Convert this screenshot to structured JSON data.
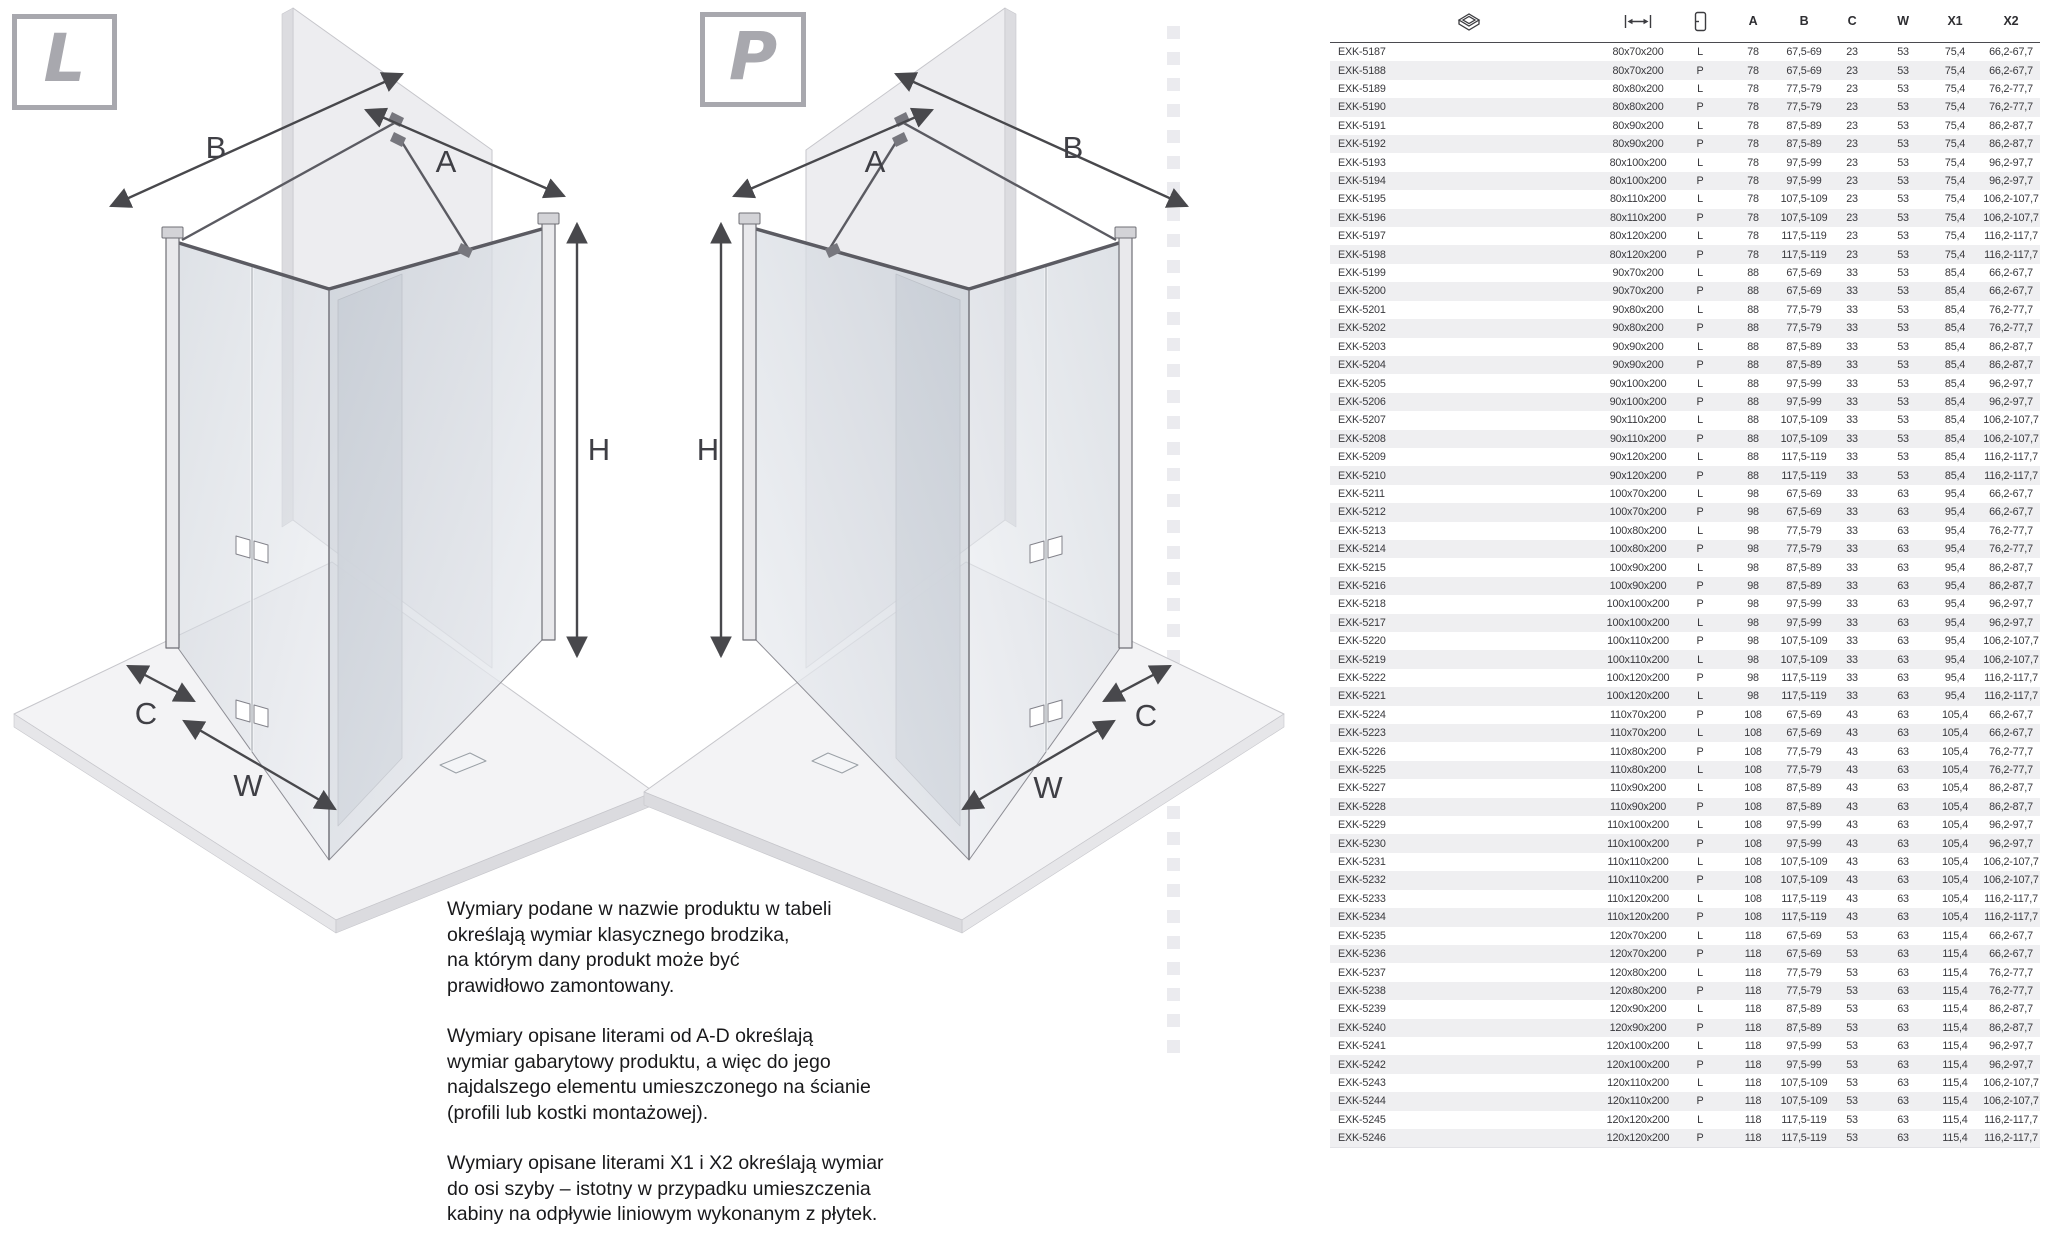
{
  "colors": {
    "badge_gray": "#a8a8ae",
    "row_alt": "#efeff1",
    "header_rule": "#4a4a4f",
    "text": "#38383c",
    "arrow": "#48484c"
  },
  "diagrams": {
    "left": {
      "badge": "L",
      "labels": {
        "A": "A",
        "B": "B",
        "C": "C",
        "H": "H",
        "W": "W"
      }
    },
    "right": {
      "badge": "P",
      "labels": {
        "A": "A",
        "B": "B",
        "C": "C",
        "H": "H",
        "W": "W"
      }
    }
  },
  "notes": {
    "paragraphs": [
      "Wymiary podane w nazwie produktu w tabeli\nokreślają wymiar klasycznego brodzika,\nna którym dany produkt może być\nprawidłowo zamontowany.",
      "Wymiary opisane literami od A-D określają\nwymiar gabarytowy produktu, a więc do jego\nnajdalszego elementu umieszczonego na ścianie\n(profili lub kostki montażowej).",
      "Wymiary opisane literami X1 i X2 określają wymiar\ndo osi szyby – istotny w przypadku umieszczenia\nkabiny na odpływie liniowym wykonanym z płytek."
    ]
  },
  "table": {
    "header": {
      "icons": [
        "shower-tray-icon",
        "width-dimension-icon",
        "door-orientation-icon"
      ],
      "columns": [
        "A",
        "B",
        "C",
        "W",
        "X1",
        "X2"
      ]
    },
    "rows": [
      [
        "EXK-5187",
        "80x70x200",
        "L",
        "78",
        "67,5-69",
        "23",
        "53",
        "75,4",
        "66,2-67,7"
      ],
      [
        "EXK-5188",
        "80x70x200",
        "P",
        "78",
        "67,5-69",
        "23",
        "53",
        "75,4",
        "66,2-67,7"
      ],
      [
        "EXK-5189",
        "80x80x200",
        "L",
        "78",
        "77,5-79",
        "23",
        "53",
        "75,4",
        "76,2-77,7"
      ],
      [
        "EXK-5190",
        "80x80x200",
        "P",
        "78",
        "77,5-79",
        "23",
        "53",
        "75,4",
        "76,2-77,7"
      ],
      [
        "EXK-5191",
        "80x90x200",
        "L",
        "78",
        "87,5-89",
        "23",
        "53",
        "75,4",
        "86,2-87,7"
      ],
      [
        "EXK-5192",
        "80x90x200",
        "P",
        "78",
        "87,5-89",
        "23",
        "53",
        "75,4",
        "86,2-87,7"
      ],
      [
        "EXK-5193",
        "80x100x200",
        "L",
        "78",
        "97,5-99",
        "23",
        "53",
        "75,4",
        "96,2-97,7"
      ],
      [
        "EXK-5194",
        "80x100x200",
        "P",
        "78",
        "97,5-99",
        "23",
        "53",
        "75,4",
        "96,2-97,7"
      ],
      [
        "EXK-5195",
        "80x110x200",
        "L",
        "78",
        "107,5-109",
        "23",
        "53",
        "75,4",
        "106,2-107,7"
      ],
      [
        "EXK-5196",
        "80x110x200",
        "P",
        "78",
        "107,5-109",
        "23",
        "53",
        "75,4",
        "106,2-107,7"
      ],
      [
        "EXK-5197",
        "80x120x200",
        "L",
        "78",
        "117,5-119",
        "23",
        "53",
        "75,4",
        "116,2-117,7"
      ],
      [
        "EXK-5198",
        "80x120x200",
        "P",
        "78",
        "117,5-119",
        "23",
        "53",
        "75,4",
        "116,2-117,7"
      ],
      [
        "EXK-5199",
        "90x70x200",
        "L",
        "88",
        "67,5-69",
        "33",
        "53",
        "85,4",
        "66,2-67,7"
      ],
      [
        "EXK-5200",
        "90x70x200",
        "P",
        "88",
        "67,5-69",
        "33",
        "53",
        "85,4",
        "66,2-67,7"
      ],
      [
        "EXK-5201",
        "90x80x200",
        "L",
        "88",
        "77,5-79",
        "33",
        "53",
        "85,4",
        "76,2-77,7"
      ],
      [
        "EXK-5202",
        "90x80x200",
        "P",
        "88",
        "77,5-79",
        "33",
        "53",
        "85,4",
        "76,2-77,7"
      ],
      [
        "EXK-5203",
        "90x90x200",
        "L",
        "88",
        "87,5-89",
        "33",
        "53",
        "85,4",
        "86,2-87,7"
      ],
      [
        "EXK-5204",
        "90x90x200",
        "P",
        "88",
        "87,5-89",
        "33",
        "53",
        "85,4",
        "86,2-87,7"
      ],
      [
        "EXK-5205",
        "90x100x200",
        "L",
        "88",
        "97,5-99",
        "33",
        "53",
        "85,4",
        "96,2-97,7"
      ],
      [
        "EXK-5206",
        "90x100x200",
        "P",
        "88",
        "97,5-99",
        "33",
        "53",
        "85,4",
        "96,2-97,7"
      ],
      [
        "EXK-5207",
        "90x110x200",
        "L",
        "88",
        "107,5-109",
        "33",
        "53",
        "85,4",
        "106,2-107,7"
      ],
      [
        "EXK-5208",
        "90x110x200",
        "P",
        "88",
        "107,5-109",
        "33",
        "53",
        "85,4",
        "106,2-107,7"
      ],
      [
        "EXK-5209",
        "90x120x200",
        "L",
        "88",
        "117,5-119",
        "33",
        "53",
        "85,4",
        "116,2-117,7"
      ],
      [
        "EXK-5210",
        "90x120x200",
        "P",
        "88",
        "117,5-119",
        "33",
        "53",
        "85,4",
        "116,2-117,7"
      ],
      [
        "EXK-5211",
        "100x70x200",
        "L",
        "98",
        "67,5-69",
        "33",
        "63",
        "95,4",
        "66,2-67,7"
      ],
      [
        "EXK-5212",
        "100x70x200",
        "P",
        "98",
        "67,5-69",
        "33",
        "63",
        "95,4",
        "66,2-67,7"
      ],
      [
        "EXK-5213",
        "100x80x200",
        "L",
        "98",
        "77,5-79",
        "33",
        "63",
        "95,4",
        "76,2-77,7"
      ],
      [
        "EXK-5214",
        "100x80x200",
        "P",
        "98",
        "77,5-79",
        "33",
        "63",
        "95,4",
        "76,2-77,7"
      ],
      [
        "EXK-5215",
        "100x90x200",
        "L",
        "98",
        "87,5-89",
        "33",
        "63",
        "95,4",
        "86,2-87,7"
      ],
      [
        "EXK-5216",
        "100x90x200",
        "P",
        "98",
        "87,5-89",
        "33",
        "63",
        "95,4",
        "86,2-87,7"
      ],
      [
        "EXK-5218",
        "100x100x200",
        "P",
        "98",
        "97,5-99",
        "33",
        "63",
        "95,4",
        "96,2-97,7"
      ],
      [
        "EXK-5217",
        "100x100x200",
        "L",
        "98",
        "97,5-99",
        "33",
        "63",
        "95,4",
        "96,2-97,7"
      ],
      [
        "EXK-5220",
        "100x110x200",
        "P",
        "98",
        "107,5-109",
        "33",
        "63",
        "95,4",
        "106,2-107,7"
      ],
      [
        "EXK-5219",
        "100x110x200",
        "L",
        "98",
        "107,5-109",
        "33",
        "63",
        "95,4",
        "106,2-107,7"
      ],
      [
        "EXK-5222",
        "100x120x200",
        "P",
        "98",
        "117,5-119",
        "33",
        "63",
        "95,4",
        "116,2-117,7"
      ],
      [
        "EXK-5221",
        "100x120x200",
        "L",
        "98",
        "117,5-119",
        "33",
        "63",
        "95,4",
        "116,2-117,7"
      ],
      [
        "EXK-5224",
        "110x70x200",
        "P",
        "108",
        "67,5-69",
        "43",
        "63",
        "105,4",
        "66,2-67,7"
      ],
      [
        "EXK-5223",
        "110x70x200",
        "L",
        "108",
        "67,5-69",
        "43",
        "63",
        "105,4",
        "66,2-67,7"
      ],
      [
        "EXK-5226",
        "110x80x200",
        "P",
        "108",
        "77,5-79",
        "43",
        "63",
        "105,4",
        "76,2-77,7"
      ],
      [
        "EXK-5225",
        "110x80x200",
        "L",
        "108",
        "77,5-79",
        "43",
        "63",
        "105,4",
        "76,2-77,7"
      ],
      [
        "EXK-5227",
        "110x90x200",
        "L",
        "108",
        "87,5-89",
        "43",
        "63",
        "105,4",
        "86,2-87,7"
      ],
      [
        "EXK-5228",
        "110x90x200",
        "P",
        "108",
        "87,5-89",
        "43",
        "63",
        "105,4",
        "86,2-87,7"
      ],
      [
        "EXK-5229",
        "110x100x200",
        "L",
        "108",
        "97,5-99",
        "43",
        "63",
        "105,4",
        "96,2-97,7"
      ],
      [
        "EXK-5230",
        "110x100x200",
        "P",
        "108",
        "97,5-99",
        "43",
        "63",
        "105,4",
        "96,2-97,7"
      ],
      [
        "EXK-5231",
        "110x110x200",
        "L",
        "108",
        "107,5-109",
        "43",
        "63",
        "105,4",
        "106,2-107,7"
      ],
      [
        "EXK-5232",
        "110x110x200",
        "P",
        "108",
        "107,5-109",
        "43",
        "63",
        "105,4",
        "106,2-107,7"
      ],
      [
        "EXK-5233",
        "110x120x200",
        "L",
        "108",
        "117,5-119",
        "43",
        "63",
        "105,4",
        "116,2-117,7"
      ],
      [
        "EXK-5234",
        "110x120x200",
        "P",
        "108",
        "117,5-119",
        "43",
        "63",
        "105,4",
        "116,2-117,7"
      ],
      [
        "EXK-5235",
        "120x70x200",
        "L",
        "118",
        "67,5-69",
        "53",
        "63",
        "115,4",
        "66,2-67,7"
      ],
      [
        "EXK-5236",
        "120x70x200",
        "P",
        "118",
        "67,5-69",
        "53",
        "63",
        "115,4",
        "66,2-67,7"
      ],
      [
        "EXK-5237",
        "120x80x200",
        "L",
        "118",
        "77,5-79",
        "53",
        "63",
        "115,4",
        "76,2-77,7"
      ],
      [
        "EXK-5238",
        "120x80x200",
        "P",
        "118",
        "77,5-79",
        "53",
        "63",
        "115,4",
        "76,2-77,7"
      ],
      [
        "EXK-5239",
        "120x90x200",
        "L",
        "118",
        "87,5-89",
        "53",
        "63",
        "115,4",
        "86,2-87,7"
      ],
      [
        "EXK-5240",
        "120x90x200",
        "P",
        "118",
        "87,5-89",
        "53",
        "63",
        "115,4",
        "86,2-87,7"
      ],
      [
        "EXK-5241",
        "120x100x200",
        "L",
        "118",
        "97,5-99",
        "53",
        "63",
        "115,4",
        "96,2-97,7"
      ],
      [
        "EXK-5242",
        "120x100x200",
        "P",
        "118",
        "97,5-99",
        "53",
        "63",
        "115,4",
        "96,2-97,7"
      ],
      [
        "EXK-5243",
        "120x110x200",
        "L",
        "118",
        "107,5-109",
        "53",
        "63",
        "115,4",
        "106,2-107,7"
      ],
      [
        "EXK-5244",
        "120x110x200",
        "P",
        "118",
        "107,5-109",
        "53",
        "63",
        "115,4",
        "106,2-107,7"
      ],
      [
        "EXK-5245",
        "120x120x200",
        "L",
        "118",
        "117,5-119",
        "53",
        "63",
        "115,4",
        "116,2-117,7"
      ],
      [
        "EXK-5246",
        "120x120x200",
        "P",
        "118",
        "117,5-119",
        "53",
        "63",
        "115,4",
        "116,2-117,7"
      ]
    ]
  }
}
